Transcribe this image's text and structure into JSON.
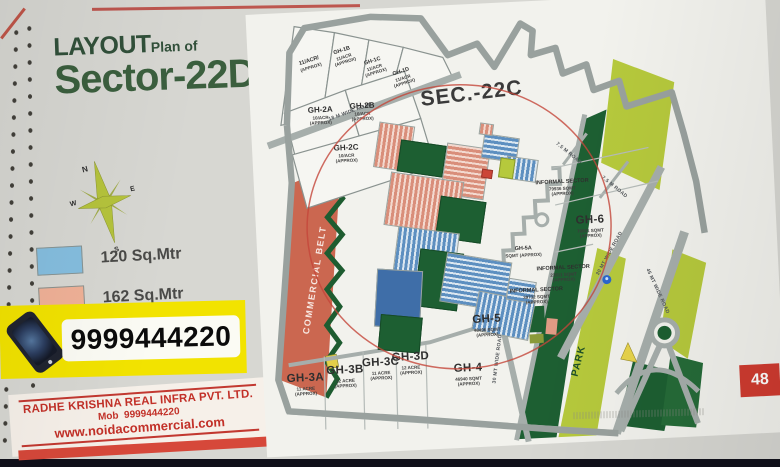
{
  "page": {
    "title_line1": "LAYOUT",
    "title_line2": "Plan of",
    "title_line3": "Sector-22D",
    "compass": {
      "north": "N",
      "east": "E",
      "south": "S",
      "west": "W"
    },
    "legend": [
      {
        "label": "120 Sq.Mtr",
        "color": "#85bedf"
      },
      {
        "label": "162 Sq.Mtr",
        "color": "#f0b197"
      }
    ],
    "phone_banner": "9999444220",
    "company": {
      "name": "RADHE KRISHNA REAL INFRA PVT. LTD.",
      "mobile_label": "Mob",
      "mobile": "9999444220",
      "website": "www.noidacommercial.com"
    },
    "page_number": "48"
  },
  "map": {
    "sector_label": "SEC.-22C",
    "commercial_belt_label": "COMMERCIAL BELT",
    "park_label": "PARK",
    "roads": [
      {
        "label": "18 M WIDE ROAD"
      },
      {
        "label": "30 MT WIDE ROAD"
      },
      {
        "label": "30 MT WIDE ROAD"
      },
      {
        "label": "45 MT WIDE ROAD"
      },
      {
        "label": "7.5 M ROAD"
      },
      {
        "label": "7.5 M ROAD"
      }
    ],
    "plots": [
      {
        "name": "11/ACR/",
        "area": "(APPROX)",
        "approx": ""
      },
      {
        "name": "GH-1B",
        "area": "11/ACR",
        "approx": "(APPROX)"
      },
      {
        "name": "GH-1C",
        "area": "11/ACR",
        "approx": "(APPROX)"
      },
      {
        "name": "GH-1D",
        "area": "11/ACR",
        "approx": "(APPROX)"
      },
      {
        "name": "GH-2A",
        "area": "10/ACR",
        "approx": "(APPROX)"
      },
      {
        "name": "GH-2B",
        "area": "10/ACR",
        "approx": "(APPROX)"
      },
      {
        "name": "GH-2C",
        "area": "10/ACR",
        "approx": "(APPROX)"
      },
      {
        "name": "GH-3A",
        "area": "11 ACRE",
        "approx": "(APPROX)"
      },
      {
        "name": "GH-3B",
        "area": "12 ACRE",
        "approx": "(APPROX)"
      },
      {
        "name": "GH-3C",
        "area": "11 ACRE",
        "approx": "(APPROX)"
      },
      {
        "name": "GH-3D",
        "area": "12 ACRE",
        "approx": "(APPROX)"
      },
      {
        "name": "GH-4",
        "area": "46940 SQMT",
        "approx": "(APPROX)"
      },
      {
        "name": "GH-5",
        "area": "48496 SQMT",
        "approx": "(APPROX)"
      },
      {
        "name": "GH-5A",
        "area": "SQMT (APPROX)",
        "approx": ""
      },
      {
        "name": "GH-6",
        "area": "78881 SQMT",
        "approx": "(APPROX)"
      },
      {
        "name": "INFORMAL SECTOR",
        "area": "79936 SQMT",
        "approx": "(APPROX)"
      },
      {
        "name": "INFORMAL SECTOR",
        "area": "23911 SQMT",
        "approx": "(APPROX)"
      },
      {
        "name": "INFORMAL SECTOR",
        "area": "39732 SQMT",
        "approx": "(APPROX)"
      }
    ],
    "colors": {
      "legend_120_blue": "#85bedf",
      "legend_162_salmon": "#f0b197",
      "banner_yellow": "#f2e300",
      "accent_red": "#d6483a",
      "title_green": "#3b5f3e",
      "company_red": "#c23028",
      "park_dark_green": "#1d5f32",
      "park_light_green": "#b6c93c",
      "commercial_belt": "#cb6750"
    }
  }
}
